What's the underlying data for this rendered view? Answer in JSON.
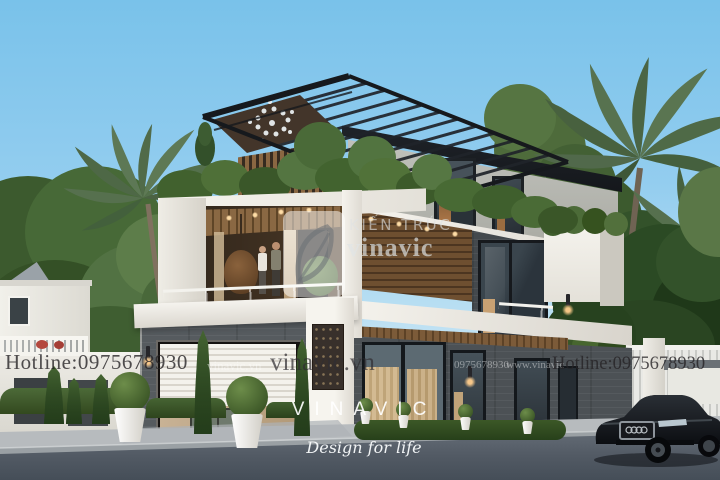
{
  "scene": {
    "type": "architectural-exterior-render",
    "subject": "Modern 3-storey villa with rooftop pergola, palms, black sedan and street foreground"
  },
  "watermarks": {
    "hotline": "Hotline:0975678930",
    "website": "vinavic.vn",
    "website_faint": "vinavic.vn",
    "phone_faint": "0975678930",
    "www_faint": "www.vinavic"
  },
  "logo_watermark": {
    "mark": "vinavic-leaf-monogram",
    "line1": "KIẾN TRÚC",
    "line2": "vinavic"
  },
  "footer_branding": {
    "wordmark": "VINAVIC",
    "slogan": "Design for life"
  },
  "colors": {
    "sky_top": "#79c2ea",
    "sky_horizon": "#e4f2f8",
    "facade_white": "#f4f2ec",
    "stone_dark": "#4e5357",
    "stone_light": "#b9bab4",
    "wood": "#7c5c3d",
    "pergola_black": "#1d2125",
    "foliage": "#4f6d38",
    "foliage_dark": "#27411f",
    "glass": "#b9d6e0",
    "warm_light": "#dfa763",
    "road": "#4d555f",
    "sidewalk": "#b7bbbe",
    "car_black": "#14171b",
    "watermark_dark": "#262326",
    "watermark_light": "#ffffff"
  }
}
